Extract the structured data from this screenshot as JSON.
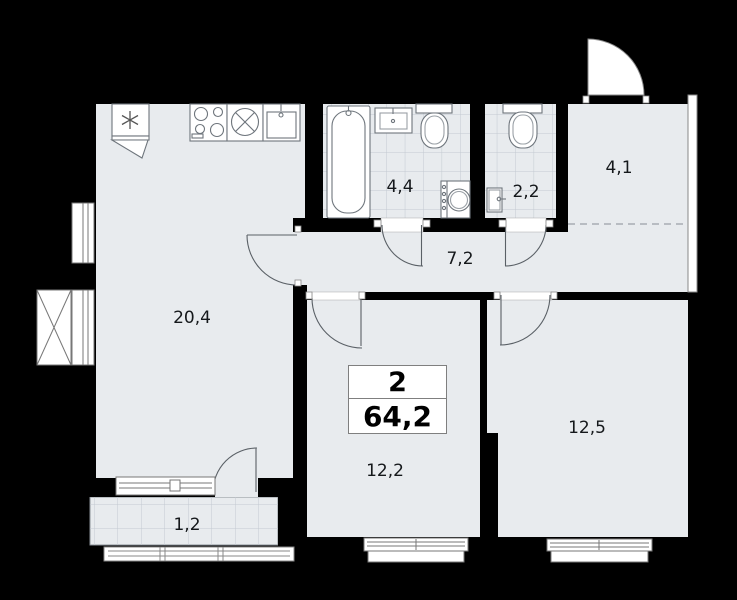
{
  "plan": {
    "info_box": {
      "rooms": "2",
      "area": "64,2"
    },
    "rooms": [
      {
        "key": "kitchen-living",
        "area": "20,4"
      },
      {
        "key": "bathroom",
        "area": "4,4"
      },
      {
        "key": "toilet",
        "area": "2,2"
      },
      {
        "key": "entry-hall",
        "area": "4,1"
      },
      {
        "key": "hallway",
        "area": "7,2"
      },
      {
        "key": "bedroom-1",
        "area": "12,2"
      },
      {
        "key": "bedroom-2",
        "area": "12,5"
      },
      {
        "key": "balcony",
        "area": "1,2"
      }
    ],
    "colors": {
      "background": "#000000",
      "floor": "#e8ebee",
      "wall": "#000000",
      "tile_line": "#c3c9d1",
      "fixture_line": "#6e757c"
    }
  }
}
